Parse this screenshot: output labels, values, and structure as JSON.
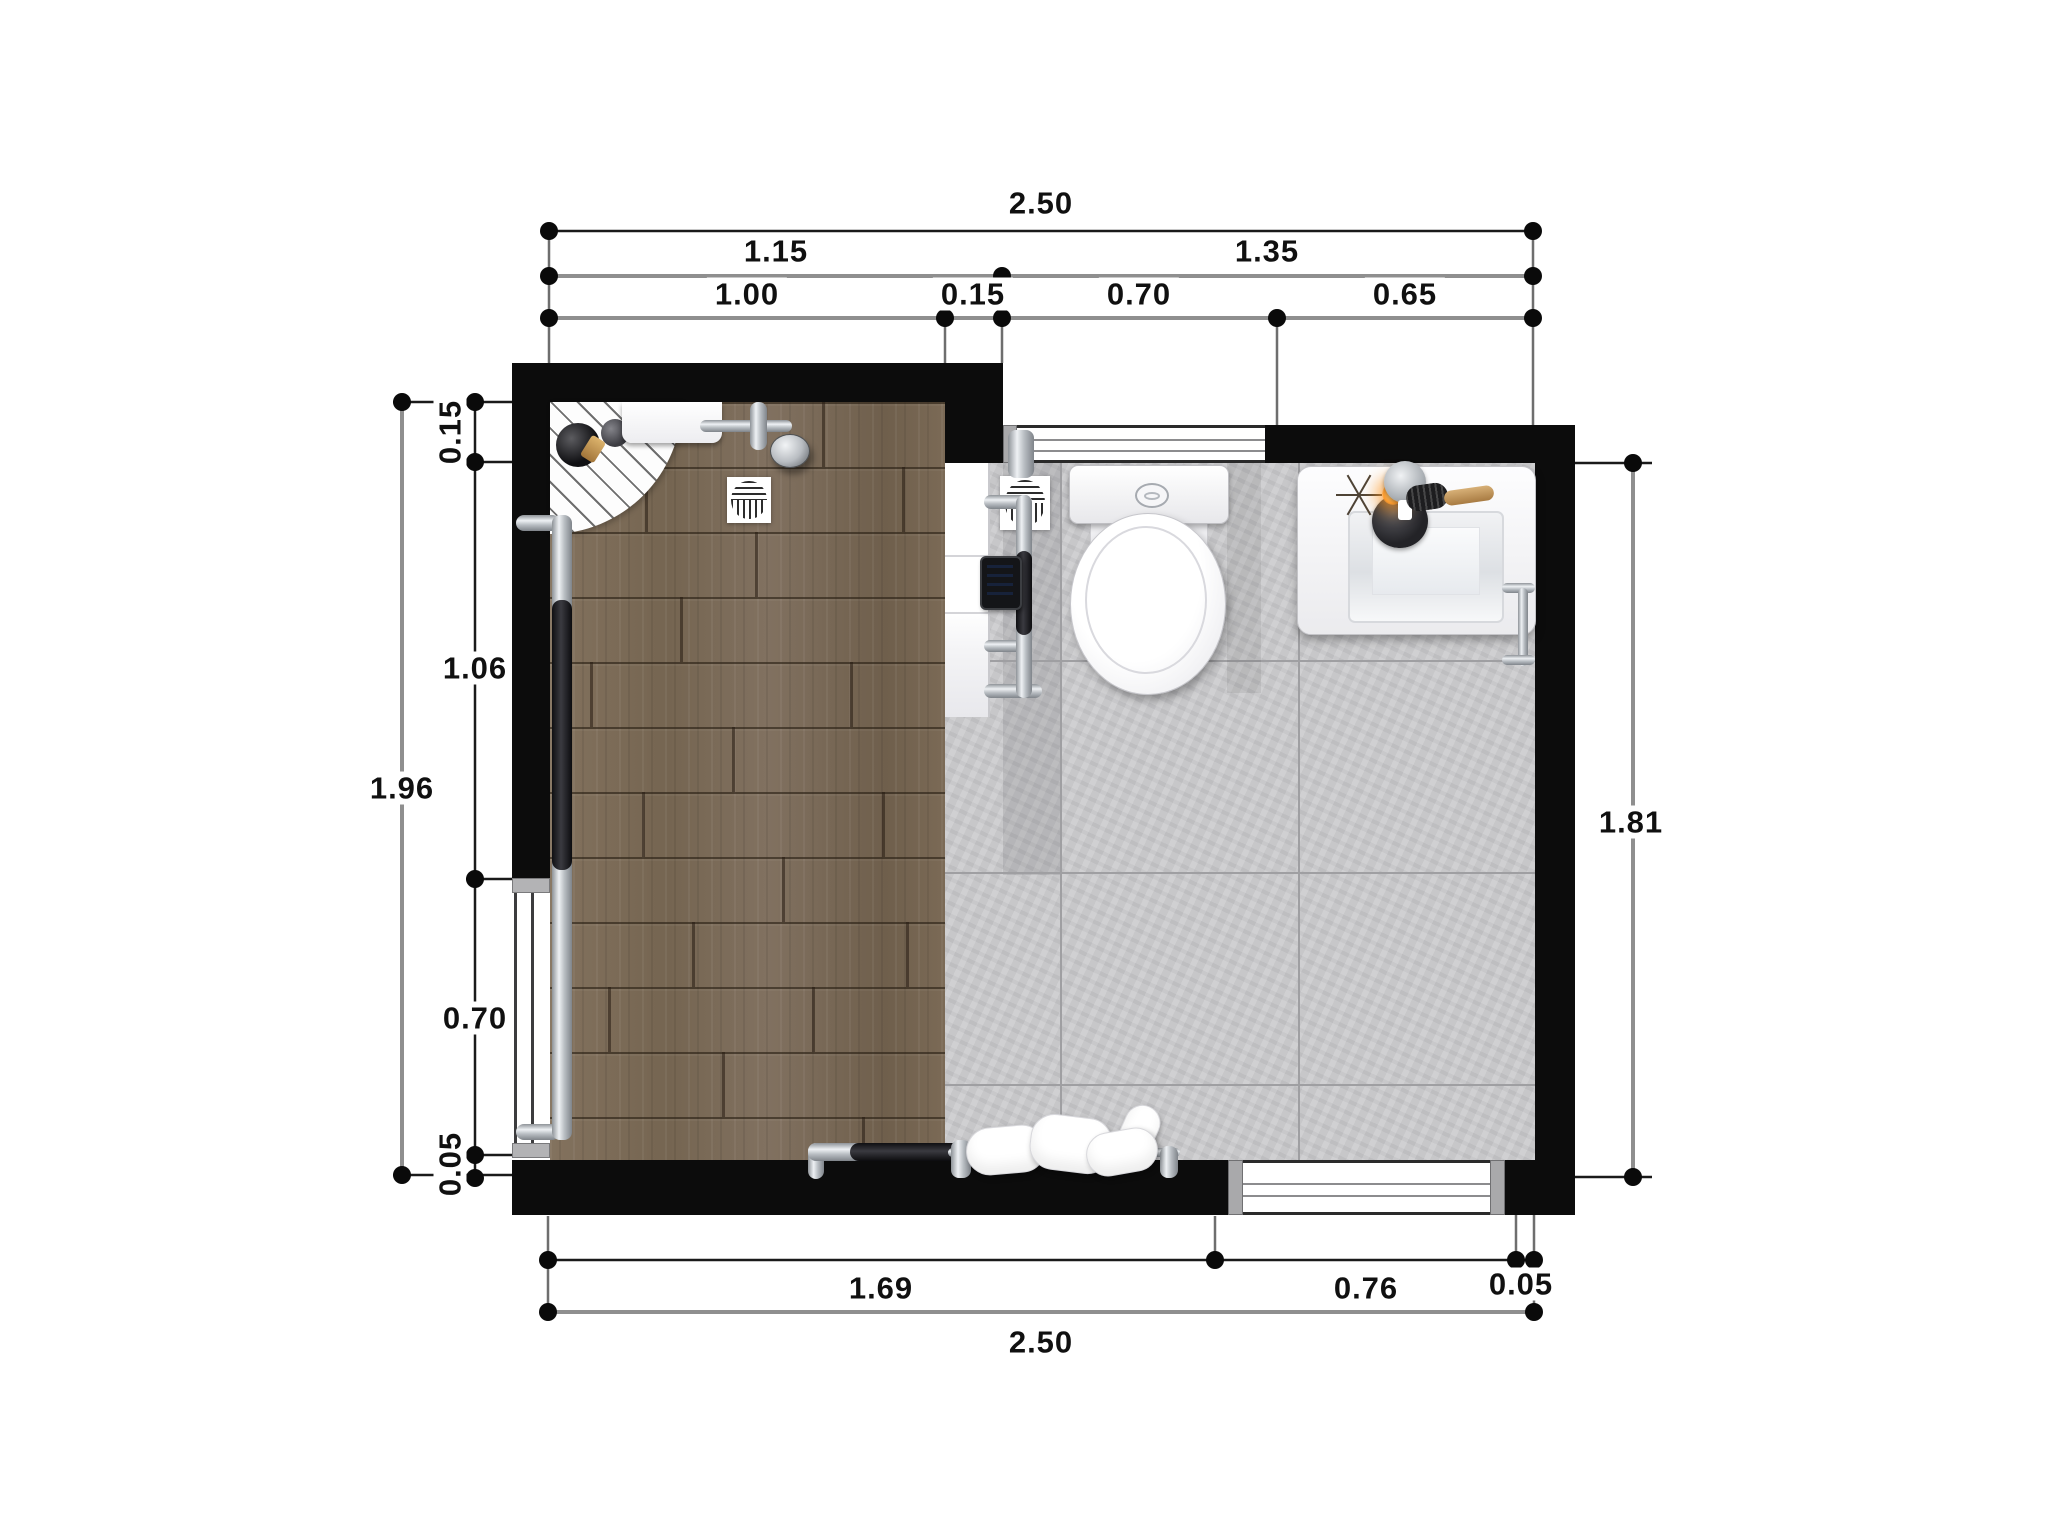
{
  "drawing": {
    "type": "bathroom-floor-plan-top-view",
    "colors": {
      "wall": "#0c0c0c",
      "wood_floor": "#7c6b57",
      "tile_floor": "#c7c7c9",
      "dimension_text": "#101010"
    }
  },
  "dimensions": {
    "top": {
      "total": "2.50",
      "upper": [
        "1.15",
        "1.35"
      ],
      "lower": [
        "1.00",
        "0.15",
        "0.70",
        "0.65"
      ]
    },
    "left": {
      "total": "1.96",
      "chain": [
        "0.15",
        "1.06",
        "0.70",
        "0.05"
      ]
    },
    "right": {
      "total": "1.81"
    },
    "bottom": {
      "chain": [
        "1.69",
        "0.76",
        "0.05"
      ],
      "total": "2.50"
    }
  },
  "fixtures": [
    "corner-shelf",
    "shampoo-bottles",
    "shower-shelf",
    "shower-head",
    "floor-drain-left",
    "grab-bar-vertical",
    "grab-bar-horizontal",
    "door-opening",
    "partition-unit",
    "towel-radiator",
    "control-tablet",
    "floor-drain-right",
    "toilet",
    "sink",
    "faucet",
    "candle-dish",
    "hairbrush",
    "dried-flower",
    "towel-rail",
    "towels",
    "window-top",
    "window-bottom"
  ]
}
